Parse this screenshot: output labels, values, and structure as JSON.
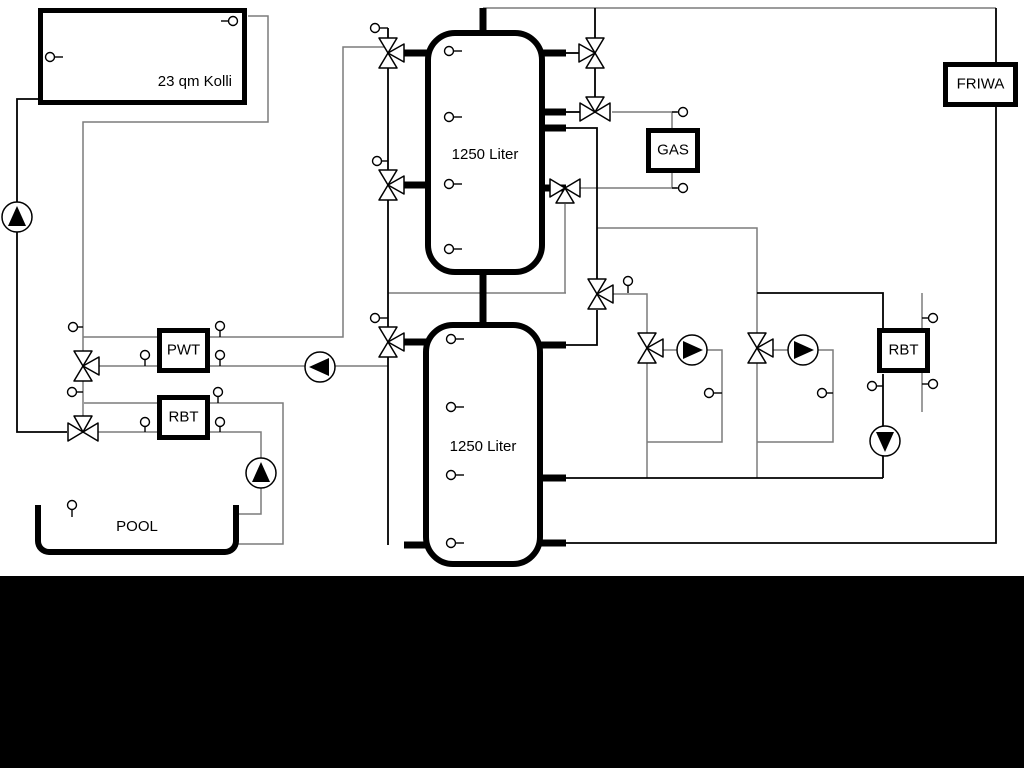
{
  "diagram": {
    "collector": {
      "label": "23 qm Kolli"
    },
    "tank1": {
      "label": "1250 Liter"
    },
    "tank2": {
      "label": "1250 Liter"
    },
    "gas": {
      "label": "GAS"
    },
    "friwa": {
      "label": "FRIWA"
    },
    "pwt": {
      "label": "PWT"
    },
    "rbt_left": {
      "label": "RBT"
    },
    "rbt_right": {
      "label": "RBT"
    },
    "pool": {
      "label": "POOL"
    },
    "colors": {
      "pipe_gray": "#7c7c7c",
      "pipe_black": "#000000",
      "background": "#ffffff",
      "footer_band": "#000000"
    }
  }
}
